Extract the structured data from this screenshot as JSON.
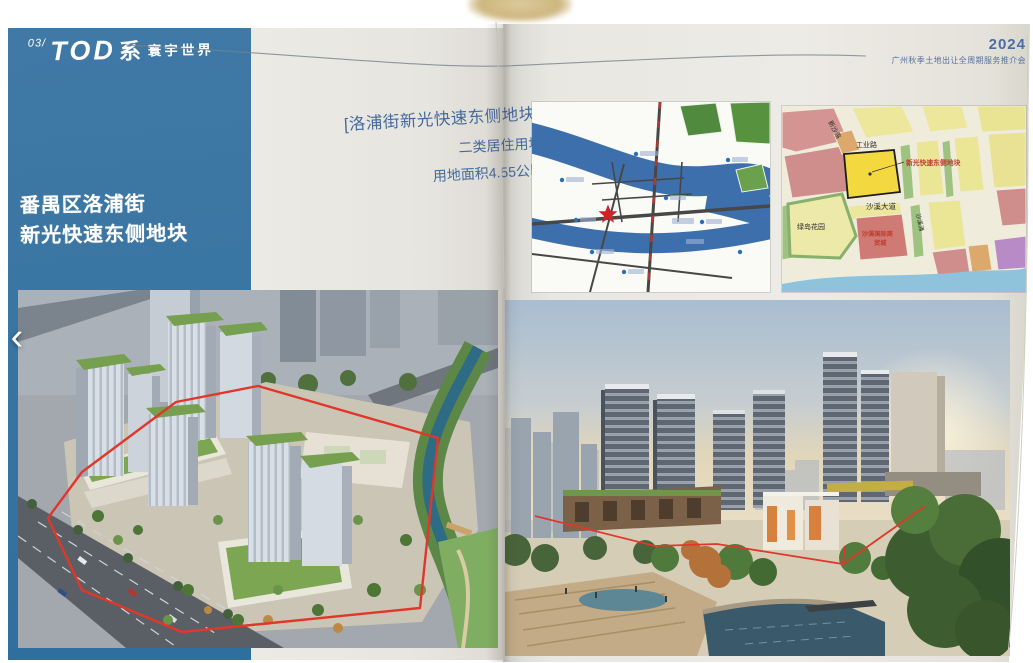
{
  "viewer": {
    "prev_label": "‹"
  },
  "brochure": {
    "header": {
      "index": "03/",
      "series_latin": "TOD",
      "series_cn": "系",
      "series_name": "寰宇世界"
    },
    "event": {
      "year": "2024",
      "subtitle": "广州秋季土地出让全周期服务推介会"
    },
    "site": {
      "district_line1": "番禺区洛浦街",
      "district_line2": "新光快速东侧地块"
    },
    "plot": {
      "bracket_name": "[洛浦街新光快速东侧地块]",
      "use_type": "二类居住用地",
      "area": "用地面积4.55公顷"
    },
    "zoning_map": {
      "road_industrial": "工业路",
      "road_xinsha": "新沙路",
      "road_shaxi_avenue": "沙溪大道",
      "park": "绿岛花园",
      "market_line1": "沙溪国际商",
      "market_line2": "贸城",
      "creek": "沙溪涌",
      "site_label": "新光快速东侧地块"
    }
  },
  "colors": {
    "panel_blue": "#3a76a3",
    "caption_blue": "#44699c",
    "event_blue": "#4a6da3",
    "boundary_red": "#df382c",
    "site_parcel_yellow": "#f4d83f",
    "map_river_blue": "#3e6fad",
    "footer_blue": "#2e6f9d"
  }
}
